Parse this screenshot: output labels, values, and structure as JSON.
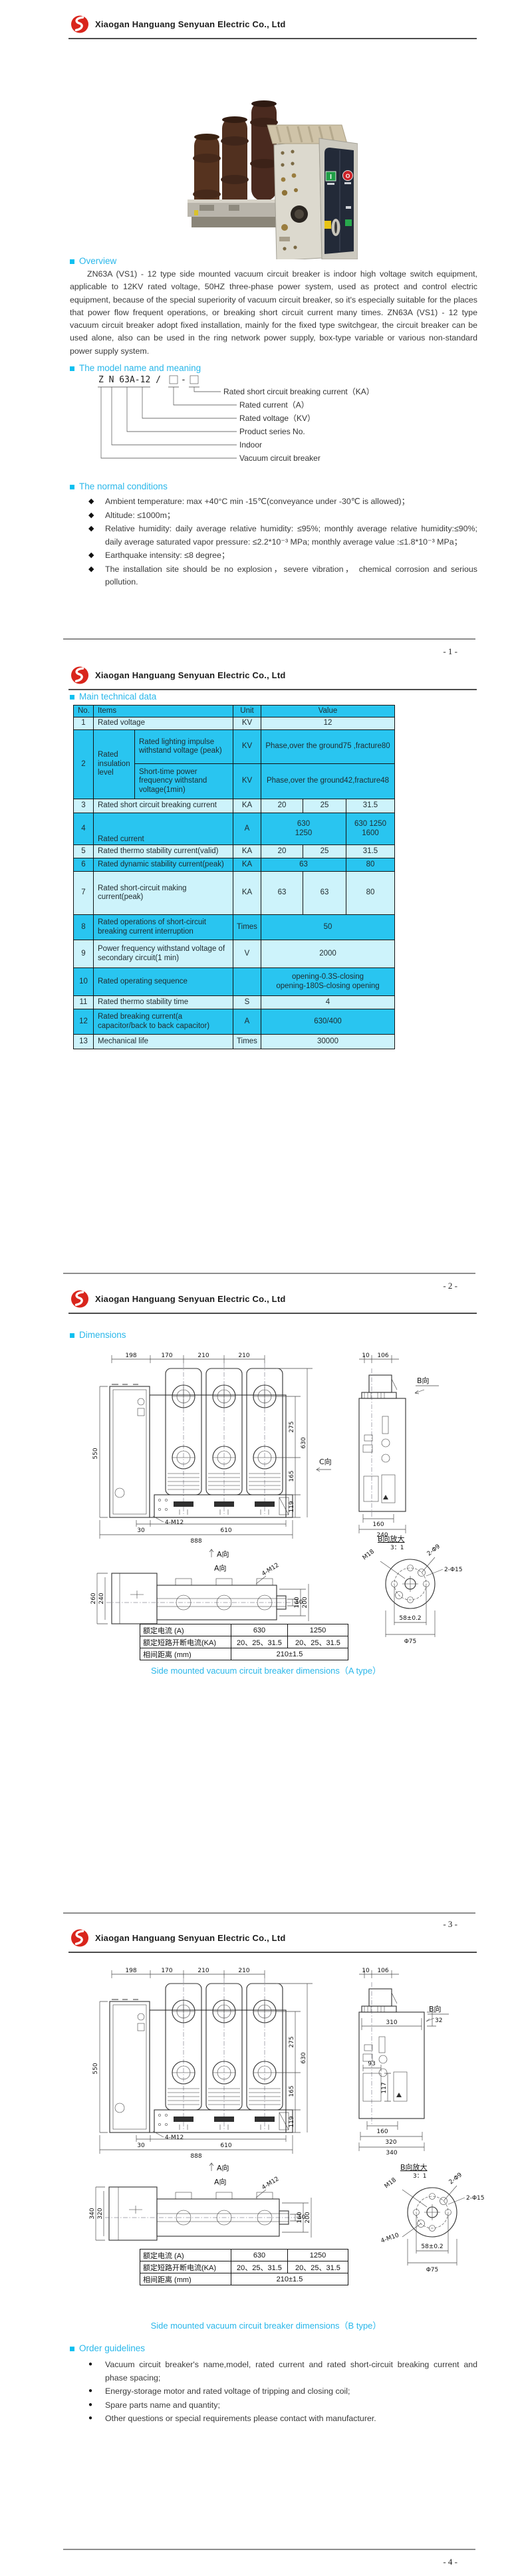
{
  "meta": {
    "accent": "#29b7ea",
    "table_cyan": "#29c5f0",
    "table_pale": "#cdf3fb",
    "logo_red": "#d9251c"
  },
  "header": {
    "company": "Xiaogan Hanguang Senyuan Electric Co., Ltd"
  },
  "footers": {
    "p1": "- 1 -",
    "p2": "- 2 -",
    "p3": "- 3 -",
    "p4": "- 4 -"
  },
  "photo": {
    "close_label": "I",
    "open_label": "O"
  },
  "overview": {
    "title": "Overview",
    "text": "ZN63A (VS1) - 12 type side mounted vacuum circuit breaker is indoor high voltage switch equipment, applicable to 12KV rated voltage, 50HZ three-phase power system, used as protect and control electric equipment, because of the special superiority of vacuum circuit breaker, so it's especially suitable for the places that power flow frequent operations, or breaking short circuit current many times. ZN63A (VS1) - 12 type vacuum circuit breaker adopt fixed installation, mainly for the fixed type switchgear, the circuit breaker can be used alone, also can be used in the ring network power supply, box-type variable or various non-standard power supply system."
  },
  "model": {
    "title": "The model name and meaning",
    "code_main": "Z N 63A-12 /",
    "code_dash": "-",
    "labels": [
      "Rated short circuit breaking current（KA）",
      "Rated current（A）",
      "Rated voltage（KV）",
      "Product series No.",
      "Indoor",
      "Vacuum circuit breaker"
    ]
  },
  "conditions": {
    "title": "The normal conditions",
    "items": [
      "Ambient temperature: max +40°C min -15℃(conveyance under -30℃ is allowed)；",
      "Altitude: ≤1000m；",
      "Relative humidity: daily average relative humidity: ≤95%; monthly average relative humidity:≤90%; daily average saturated vapor pressure: ≤2.2*10⁻³ MPa; monthly average value :≤1.8*10⁻³ MPa；",
      "Earthquake intensity: ≤8 degree；",
      "The installation site should be no explosion，severe vibration， chemical corrosion and serious pollution."
    ]
  },
  "tech": {
    "title": "Main technical data",
    "headers": [
      "No.",
      "Items",
      "Unit",
      "Value"
    ],
    "rows": {
      "r1": {
        "no": "1",
        "item": "Rated voltage",
        "unit": "KV",
        "val": "12"
      },
      "r2": {
        "no": "2",
        "group": "Rated insulation level",
        "sub1": "Rated lighting impulse withstand voltage (peak)",
        "unit1": "KV",
        "val1": "Phase,over the ground75 ,fracture80",
        "sub2": "Short-time power frequency withstand voltage(1min)",
        "unit2": "KV",
        "val2": "Phase,over the ground42,fracture48"
      },
      "r3": {
        "no": "3",
        "item": "Rated short circuit breaking current",
        "unit": "KA",
        "v1": "20",
        "v2": "25",
        "v3": "31.5"
      },
      "r4": {
        "no": "4",
        "item": "Rated current",
        "unit": "A",
        "v12": "630\n1250",
        "v3": "630 1250\n1600"
      },
      "r5": {
        "no": "5",
        "item": "Rated thermo stability current(valid)",
        "unit": "KA",
        "v1": "20",
        "v2": "25",
        "v3": "31.5"
      },
      "r6": {
        "no": "6",
        "item": "Rated dynamic stability current(peak)",
        "unit": "KA",
        "v12": "63",
        "v3": "80"
      },
      "r7": {
        "no": "7",
        "item": "Rated short-circuit making current(peak)",
        "unit": "KA",
        "v1": "63",
        "v2": "63",
        "v3": "80"
      },
      "r8": {
        "no": "8",
        "item": "Rated operations of short-circuit breaking current interruption",
        "unit": "Times",
        "val": "50"
      },
      "r9": {
        "no": "9",
        "item": "Power frequency withstand voltage of secondary circuit(1 min)",
        "unit": "V",
        "val": "2000"
      },
      "r10": {
        "no": "10",
        "item": "Rated operating sequence",
        "unit": "",
        "val": "opening-0.3S-closing\nopening-180S-closing opening"
      },
      "r11": {
        "no": "11",
        "item": "Rated thermo stability time",
        "unit": "S",
        "val": "4"
      },
      "r12": {
        "no": "12",
        "item": "Rated breaking current(a capacitor/back to back capacitor)",
        "unit": "A",
        "val": "630/400"
      },
      "r13": {
        "no": "13",
        "item": "Mechanical life",
        "unit": "Times",
        "val": "30000"
      }
    }
  },
  "dims": {
    "title": "Dimensions",
    "captionA": "Side mounted vacuum circuit breaker dimensions（A type）",
    "captionB": "Side mounted vacuum circuit breaker dimensions（B type）",
    "spec": {
      "rows": [
        [
          "额定电流 (A)",
          "630",
          "1250"
        ],
        [
          "额定短路开断电流(KA)",
          "20、25、31.5",
          "20、25、31.5"
        ],
        [
          "相间距离 (mm)",
          "210±1.5"
        ]
      ]
    },
    "drawingA": {
      "top": [
        "198",
        "170",
        "210",
        "210"
      ],
      "left": "550",
      "right": [
        "275",
        "165",
        "119",
        "630"
      ],
      "bottom": [
        "30",
        "610",
        "888"
      ],
      "bolt": "4-M12",
      "view_a": "A向",
      "view_b": "B向",
      "view_c": "C向",
      "side_top": [
        "10",
        "106"
      ],
      "side_bottom": [
        "160",
        "240"
      ],
      "aview": {
        "title": "A向",
        "left": [
          "260",
          "240"
        ],
        "right": [
          "10",
          "160",
          "200"
        ],
        "bolt": "4-M12"
      },
      "detail": {
        "title": "B向放大",
        "scale": "3：1",
        "l1": "M18",
        "l2": "2-Φ9",
        "l3": "2-Φ15",
        "d1": "58±0.2",
        "d2": "Φ75"
      }
    },
    "drawingB": {
      "top": [
        "198",
        "170",
        "210",
        "210"
      ],
      "left": "550",
      "right": [
        "275",
        "165",
        "119",
        "630"
      ],
      "bottom": [
        "30",
        "610",
        "888"
      ],
      "bolt": "4-M12",
      "view_a": "A向",
      "view_b": "B向",
      "side_top": [
        "10",
        "106"
      ],
      "side_mid": [
        "310",
        "32",
        "93",
        "117"
      ],
      "side_bottom": [
        "160",
        "320",
        "340"
      ],
      "aview": {
        "title": "A向",
        "left": [
          "340",
          "320"
        ],
        "right": [
          "10",
          "160",
          "200"
        ],
        "bolt": "4-M12"
      },
      "detail": {
        "title": "B向放大",
        "scale": "3：1",
        "l1": "M18",
        "l2": "2-Φ9",
        "l3": "2-Φ15",
        "l4": "4-M10",
        "d1": "58±0.2",
        "d2": "Φ75"
      }
    }
  },
  "order": {
    "title": "Order guidelines",
    "items": [
      "Vacuum circuit breaker's name,model, rated current and rated short-circuit breaking current and phase spacing;",
      "Energy-storage motor and rated voltage of tripping and closing coil;",
      "Spare parts name and quantity;",
      "Other questions or special requirements please contact with manufacturer."
    ]
  }
}
